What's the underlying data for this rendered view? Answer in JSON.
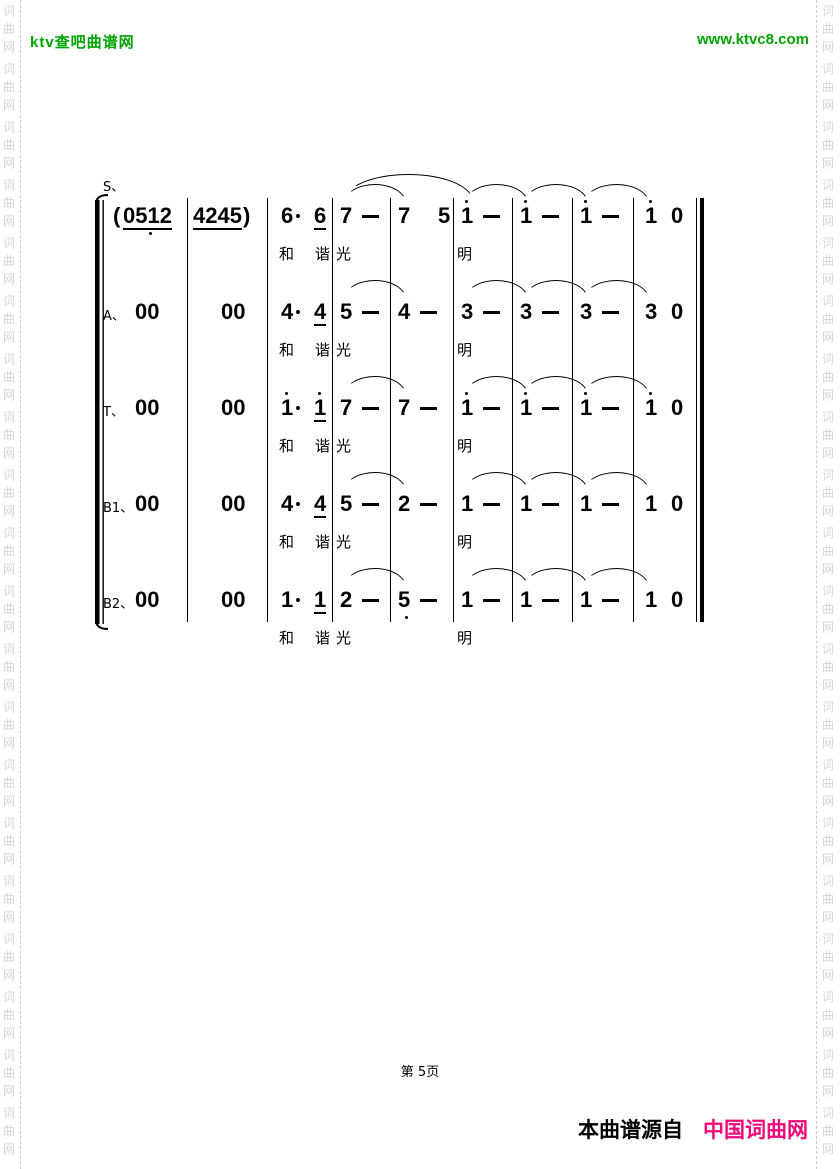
{
  "header": {
    "site_name": "ktv查吧曲谱网",
    "site_url": "www.ktvc8.com"
  },
  "watermark": {
    "chars": [
      "词",
      "曲",
      "网"
    ]
  },
  "colors": {
    "green": "#00a300",
    "pink": "#ee0678",
    "watermark": "#d6d6d6",
    "ink": "#000000"
  },
  "score": {
    "voices": [
      {
        "label": "S、",
        "measures": [
          [
            {
              "t": "("
            },
            {
              "t": "0512",
              "u": 1,
              "db": 1
            }
          ],
          [
            {
              "t": "4245",
              "u": 1
            },
            {
              "t": ")"
            }
          ],
          [
            {
              "t": "6"
            },
            {
              "t": "dot"
            },
            {
              "t": "6",
              "u": 1
            }
          ],
          [
            {
              "t": "7"
            },
            {
              "t": "dash"
            }
          ],
          [
            {
              "t": "7"
            },
            {
              "t": "5"
            }
          ],
          [
            {
              "t": "1",
              "da": 1
            },
            {
              "t": "dash"
            }
          ],
          [
            {
              "t": "1",
              "da": 1
            },
            {
              "t": "dash"
            }
          ],
          [
            {
              "t": "1",
              "da": 1
            },
            {
              "t": "dash"
            }
          ],
          [
            {
              "t": "1",
              "da": 1
            },
            {
              "t": "0"
            }
          ]
        ],
        "slurs": [
          {
            "from": 3,
            "to": 4
          },
          {
            "from": 3,
            "to": 5,
            "high": true
          },
          {
            "from": 5,
            "to": 6
          },
          {
            "from": 6,
            "to": 7
          },
          {
            "from": 7,
            "to": 8
          }
        ],
        "lyrics": [
          {
            "text": "和",
            "m": 2,
            "slot": 0
          },
          {
            "text": "谐",
            "m": 2,
            "slot": 2
          },
          {
            "text": "光",
            "m": 3,
            "slot": 0
          },
          {
            "text": "明",
            "m": 5,
            "slot": 0
          }
        ]
      },
      {
        "label": "A、",
        "measures": [
          [
            {
              "t": "00"
            }
          ],
          [
            {
              "t": "00"
            }
          ],
          [
            {
              "t": "4"
            },
            {
              "t": "dot"
            },
            {
              "t": "4",
              "u": 1
            }
          ],
          [
            {
              "t": "5"
            },
            {
              "t": "dash"
            }
          ],
          [
            {
              "t": "4"
            },
            {
              "t": "dash"
            }
          ],
          [
            {
              "t": "3"
            },
            {
              "t": "dash"
            }
          ],
          [
            {
              "t": "3"
            },
            {
              "t": "dash"
            }
          ],
          [
            {
              "t": "3"
            },
            {
              "t": "dash"
            }
          ],
          [
            {
              "t": "3"
            },
            {
              "t": "0"
            }
          ]
        ],
        "slurs": [
          {
            "from": 3,
            "to": 4
          },
          {
            "from": 5,
            "to": 6
          },
          {
            "from": 6,
            "to": 7
          },
          {
            "from": 7,
            "to": 8
          }
        ],
        "lyrics": [
          {
            "text": "和",
            "m": 2,
            "slot": 0
          },
          {
            "text": "谐",
            "m": 2,
            "slot": 2
          },
          {
            "text": "光",
            "m": 3,
            "slot": 0
          },
          {
            "text": "明",
            "m": 5,
            "slot": 0
          }
        ]
      },
      {
        "label": "T、",
        "measures": [
          [
            {
              "t": "00"
            }
          ],
          [
            {
              "t": "00"
            }
          ],
          [
            {
              "t": "1",
              "da": 1
            },
            {
              "t": "dot"
            },
            {
              "t": "1",
              "da": 1,
              "u": 1
            }
          ],
          [
            {
              "t": "7"
            },
            {
              "t": "dash"
            }
          ],
          [
            {
              "t": "7"
            },
            {
              "t": "dash"
            }
          ],
          [
            {
              "t": "1",
              "da": 1
            },
            {
              "t": "dash"
            }
          ],
          [
            {
              "t": "1",
              "da": 1
            },
            {
              "t": "dash"
            }
          ],
          [
            {
              "t": "1",
              "da": 1
            },
            {
              "t": "dash"
            }
          ],
          [
            {
              "t": "1",
              "da": 1
            },
            {
              "t": "0"
            }
          ]
        ],
        "slurs": [
          {
            "from": 3,
            "to": 4
          },
          {
            "from": 5,
            "to": 6
          },
          {
            "from": 6,
            "to": 7
          },
          {
            "from": 7,
            "to": 8
          }
        ],
        "lyrics": [
          {
            "text": "和",
            "m": 2,
            "slot": 0
          },
          {
            "text": "谐",
            "m": 2,
            "slot": 2
          },
          {
            "text": "光",
            "m": 3,
            "slot": 0
          },
          {
            "text": "明",
            "m": 5,
            "slot": 0
          }
        ]
      },
      {
        "label": "B1、",
        "measures": [
          [
            {
              "t": "00"
            }
          ],
          [
            {
              "t": "00"
            }
          ],
          [
            {
              "t": "4"
            },
            {
              "t": "dot"
            },
            {
              "t": "4",
              "u": 1
            }
          ],
          [
            {
              "t": "5"
            },
            {
              "t": "dash"
            }
          ],
          [
            {
              "t": "2"
            },
            {
              "t": "dash"
            }
          ],
          [
            {
              "t": "1"
            },
            {
              "t": "dash"
            }
          ],
          [
            {
              "t": "1"
            },
            {
              "t": "dash"
            }
          ],
          [
            {
              "t": "1"
            },
            {
              "t": "dash"
            }
          ],
          [
            {
              "t": "1"
            },
            {
              "t": "0"
            }
          ]
        ],
        "slurs": [
          {
            "from": 3,
            "to": 4
          },
          {
            "from": 5,
            "to": 6
          },
          {
            "from": 6,
            "to": 7
          },
          {
            "from": 7,
            "to": 8
          }
        ],
        "lyrics": [
          {
            "text": "和",
            "m": 2,
            "slot": 0
          },
          {
            "text": "谐",
            "m": 2,
            "slot": 2
          },
          {
            "text": "光",
            "m": 3,
            "slot": 0
          },
          {
            "text": "明",
            "m": 5,
            "slot": 0
          }
        ]
      },
      {
        "label": "B2、",
        "measures": [
          [
            {
              "t": "00"
            }
          ],
          [
            {
              "t": "00"
            }
          ],
          [
            {
              "t": "1"
            },
            {
              "t": "dot"
            },
            {
              "t": "1",
              "u": 1
            }
          ],
          [
            {
              "t": "2"
            },
            {
              "t": "dash"
            }
          ],
          [
            {
              "t": "5",
              "db": 1
            },
            {
              "t": "dash"
            }
          ],
          [
            {
              "t": "1"
            },
            {
              "t": "dash"
            }
          ],
          [
            {
              "t": "1"
            },
            {
              "t": "dash"
            }
          ],
          [
            {
              "t": "1"
            },
            {
              "t": "dash"
            }
          ],
          [
            {
              "t": "1"
            },
            {
              "t": "0"
            }
          ]
        ],
        "slurs": [
          {
            "from": 3,
            "to": 4
          },
          {
            "from": 5,
            "to": 6
          },
          {
            "from": 6,
            "to": 7
          },
          {
            "from": 7,
            "to": 8
          }
        ],
        "lyrics": [
          {
            "text": "和",
            "m": 2,
            "slot": 0
          },
          {
            "text": "谐",
            "m": 2,
            "slot": 2
          },
          {
            "text": "光",
            "m": 3,
            "slot": 0
          },
          {
            "text": "明",
            "m": 5,
            "slot": 0
          }
        ]
      }
    ]
  },
  "footer": {
    "page_label": "第 5页",
    "source_prefix": "本曲谱源自",
    "source_name": "中国词曲网"
  }
}
